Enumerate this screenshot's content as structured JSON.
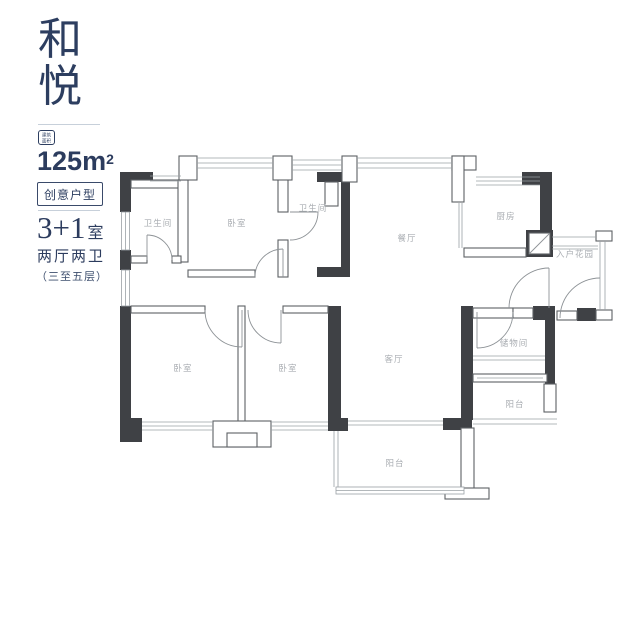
{
  "panel": {
    "title_char_1": "和",
    "title_char_2": "悦",
    "badge_line_1": "建筑",
    "badge_line_2": "面积",
    "area_number": "125",
    "area_unit": "m",
    "area_exponent": "2",
    "tag_label": "创意户型",
    "layout_main": "3+1",
    "layout_suffix": "室",
    "layout_detail": "两厅两卫",
    "floors_note": "（三至五层）",
    "accent_color": "#2d3e60"
  },
  "floorplan": {
    "wall_color": "#3f4145",
    "light_line_color": "#9aa0a5",
    "label_color": "#a9adb2",
    "rooms": [
      {
        "text": "卫生间"
      },
      {
        "text": "卧室"
      },
      {
        "text": "卫生间"
      },
      {
        "text": "餐厅"
      },
      {
        "text": "厨房"
      },
      {
        "text": "入户花园"
      },
      {
        "text": "卧室"
      },
      {
        "text": "卧室"
      },
      {
        "text": "客厅"
      },
      {
        "text": "储物间"
      },
      {
        "text": "阳台"
      },
      {
        "text": "阳台"
      }
    ]
  }
}
